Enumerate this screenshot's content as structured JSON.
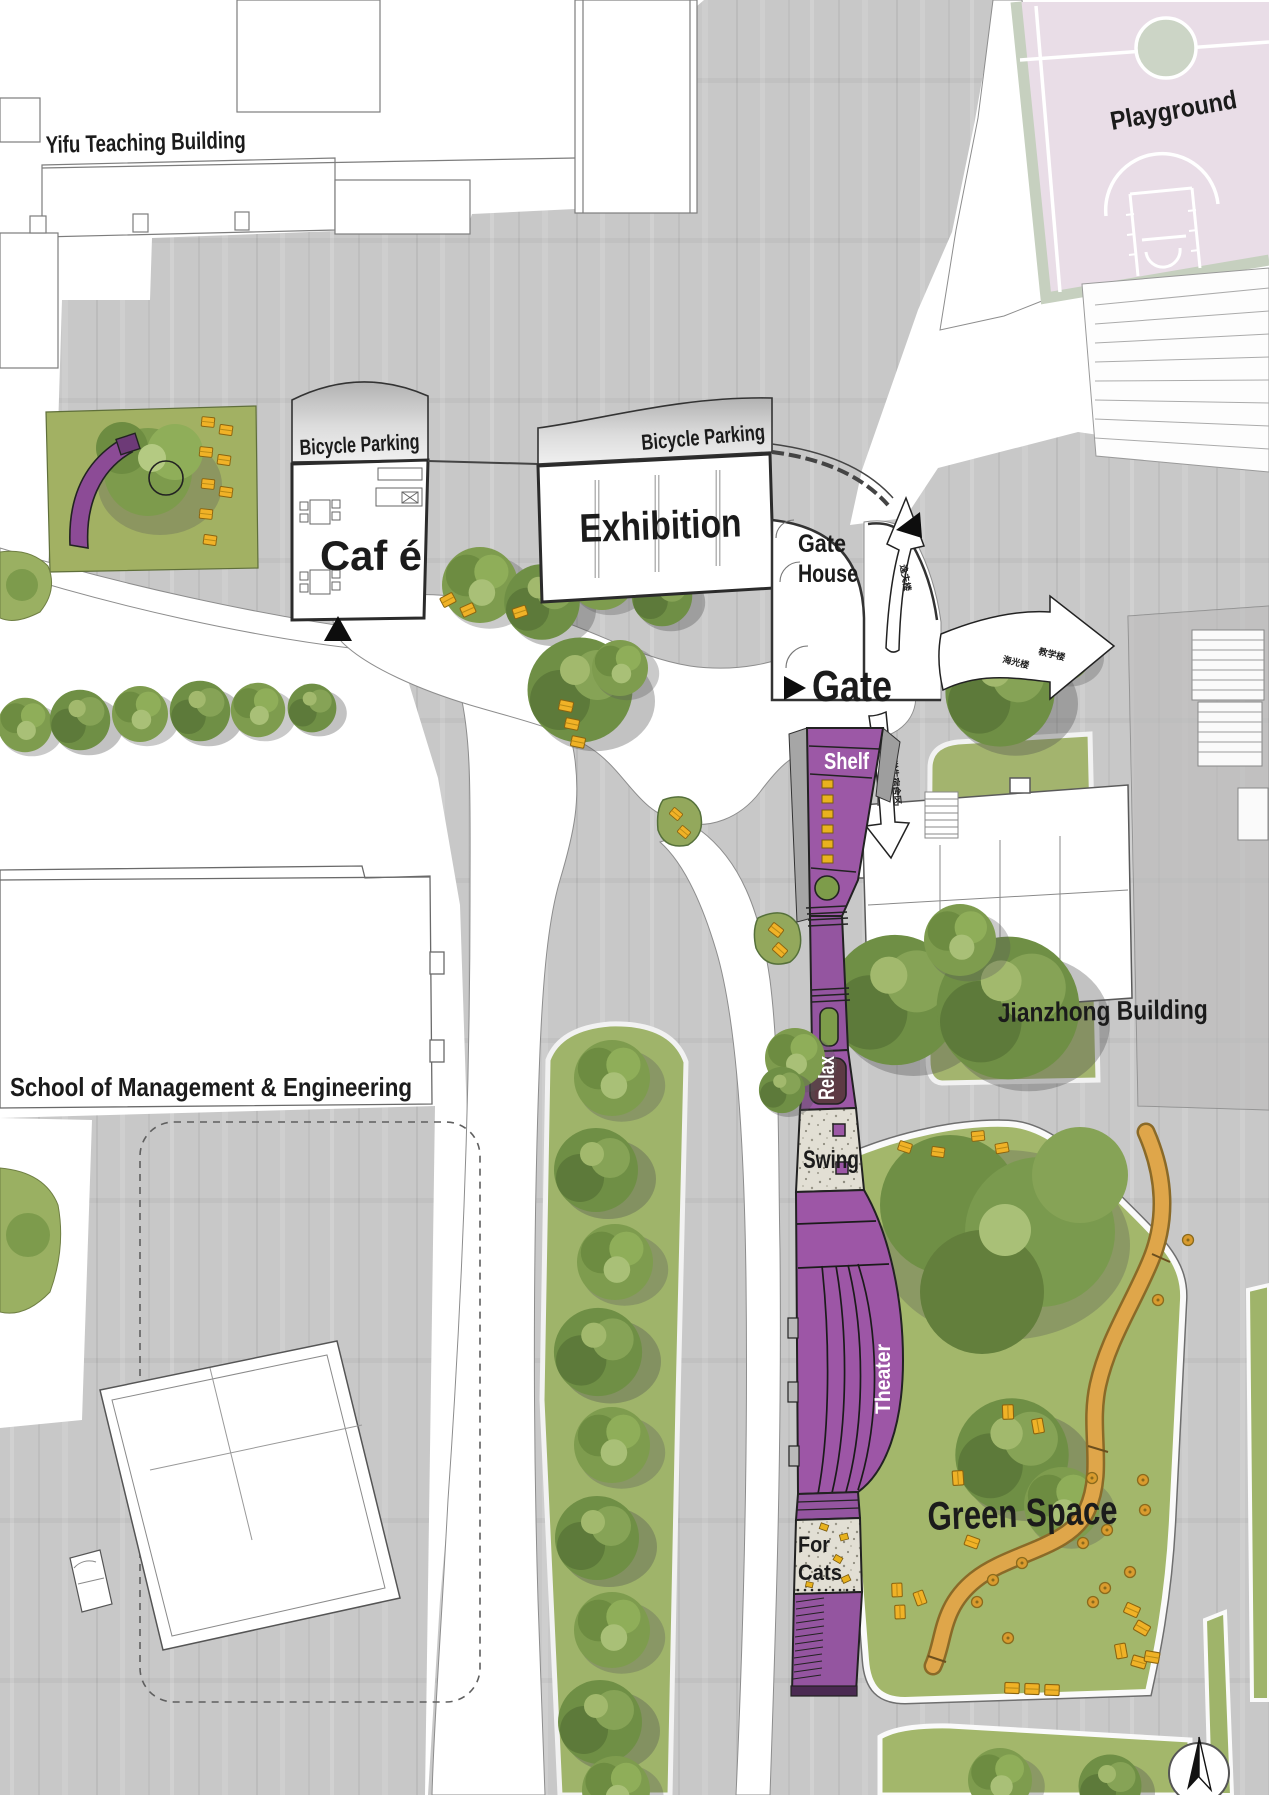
{
  "map_title": "Campus Landscape Site Plan",
  "labels": {
    "yifu": "Yifu Teaching Building",
    "playground": "Playground",
    "bicycle_parking_left": "Bicycle Parking",
    "bicycle_parking_right": "Bicycle Parking",
    "cafe": "Caf é",
    "exhibition": "Exhibition",
    "gate_house_line1": "Gate",
    "gate_house_line2": "House",
    "gate": "Gate",
    "shelf": "Shelf",
    "relax": "Relax",
    "swing": "Swing",
    "theater": "Theater",
    "for_cats_line1": "For",
    "for_cats_line2": "Cats",
    "green_space": "Green Space",
    "jianzhong": "Jianzhong Building",
    "school": "School of Management & Engineering"
  },
  "annotations": {
    "arrow_up_text": "逸夫楼",
    "arrow_right_text_a": "海光楼",
    "arrow_right_text_b": "教学楼",
    "arrow_down_text": "学生宿舍区"
  },
  "colors": {
    "plaza": "#c8c8c8",
    "promenade_purple": "#9c58a6",
    "grass": "#a3b46e",
    "court_pink": "#e9dde7",
    "bench_yellow": "#f0b227",
    "path_orange": "#dfa64a"
  }
}
